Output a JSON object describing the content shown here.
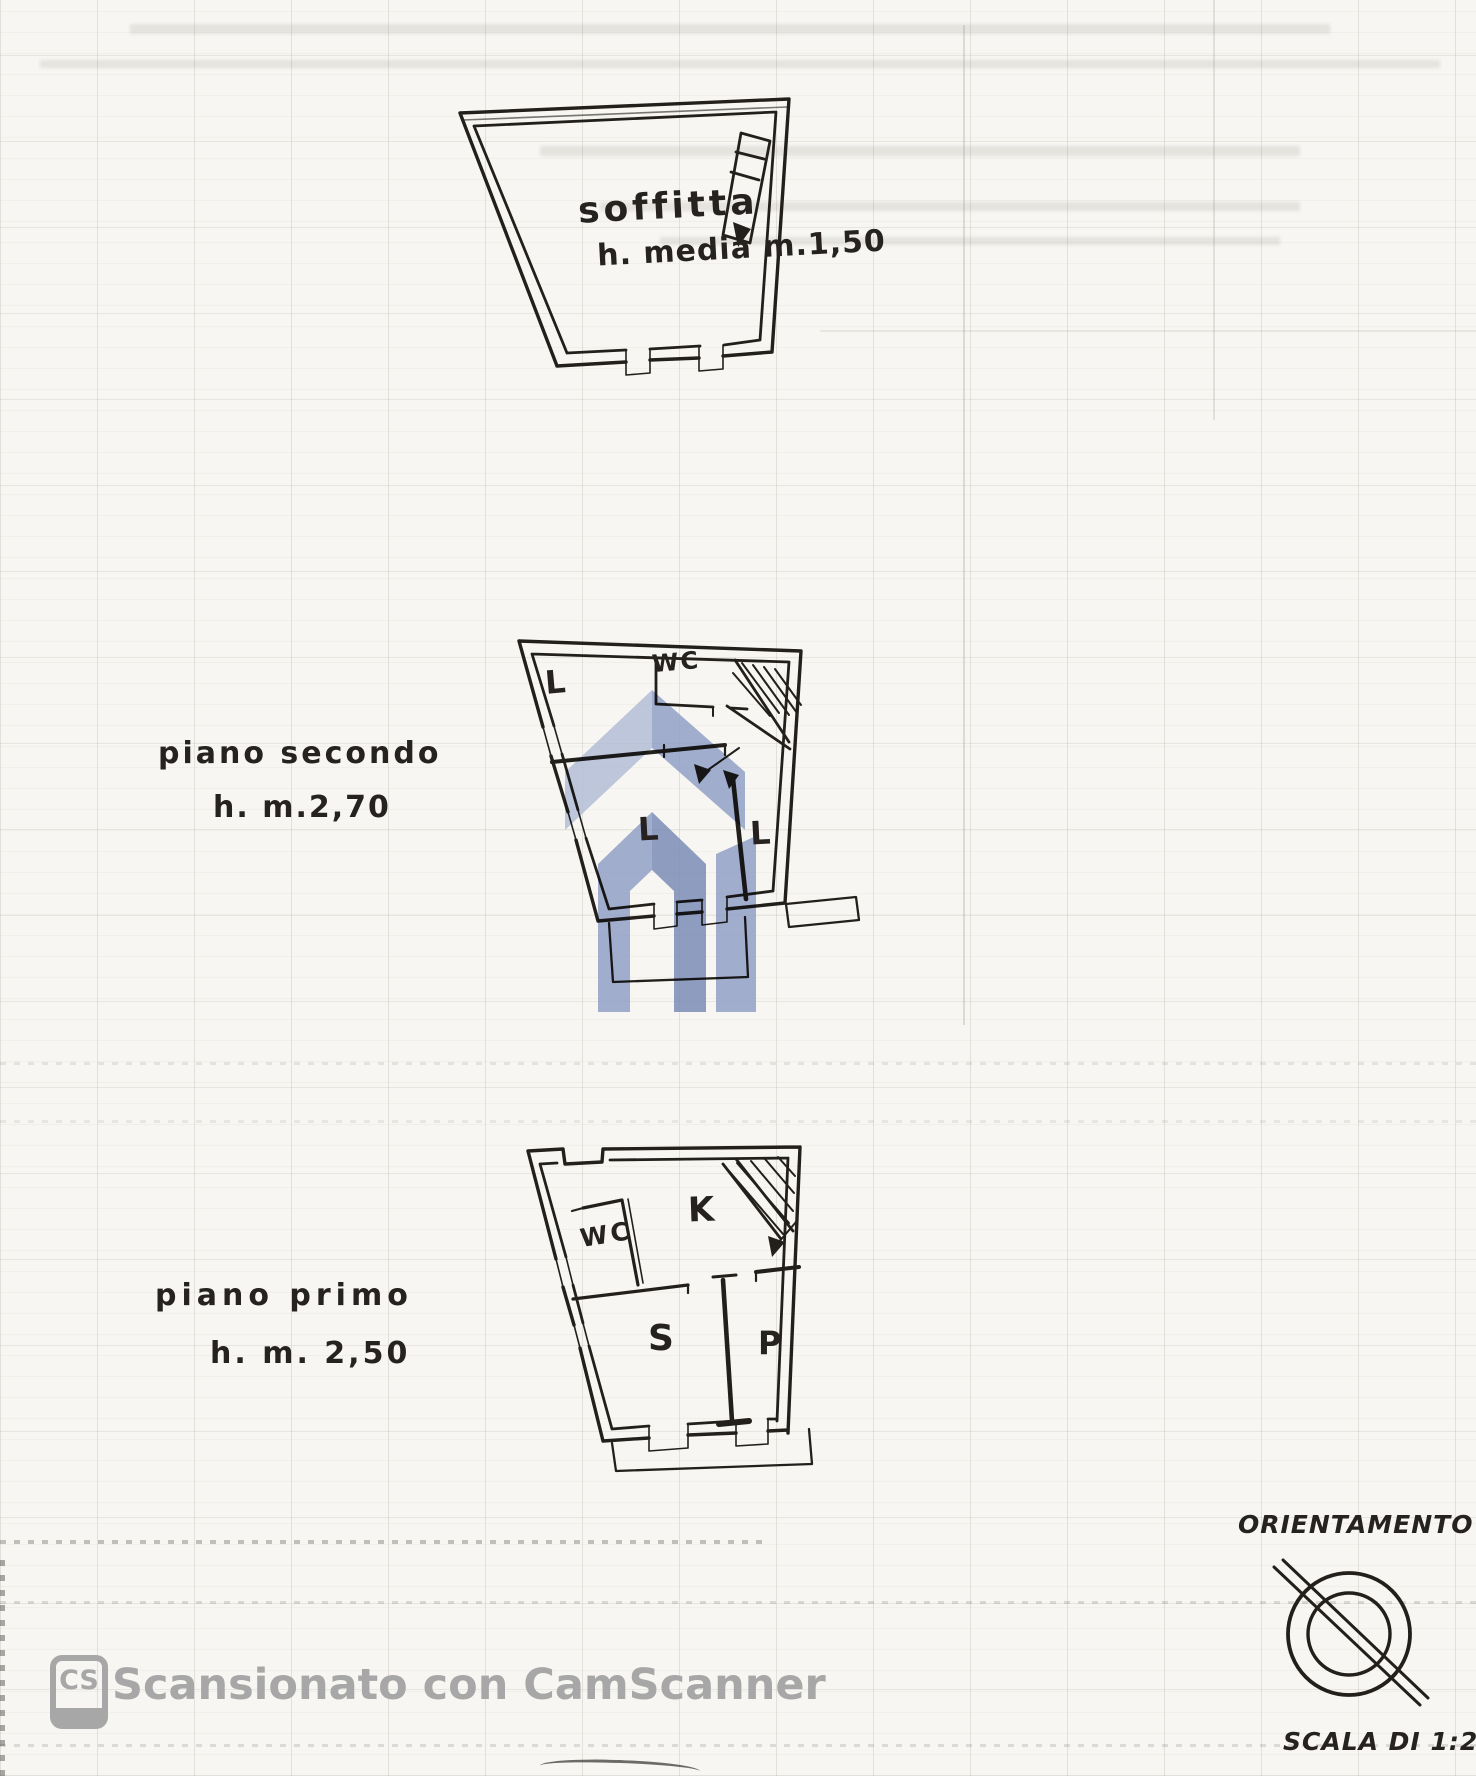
{
  "colors": {
    "ink": "#23201c",
    "paper": "#f7f6f2",
    "watermark_gray": "#a7a7a7",
    "logo_light": "#b0bbd4",
    "logo_mid": "#8d9cc4",
    "logo_dark": "#7687b5"
  },
  "soffitta": {
    "room_label": "soffitta",
    "height_label": "h. media m.1,50"
  },
  "piano_secondo": {
    "floor_label": "piano secondo",
    "height_label": "h. m.2,70",
    "room_l_top": "L",
    "room_wc": "WC",
    "room_l_left": "L",
    "room_l_right": "L"
  },
  "piano_primo": {
    "floor_label": "piano primo",
    "height_label": "h. m. 2,50",
    "room_wc": "WC",
    "room_k": "K",
    "room_s": "S",
    "room_p": "P"
  },
  "orientation_label": "ORIENTAMENTO",
  "scale_label": "SCALA DI 1:200",
  "scanner": {
    "badge": "CS",
    "text": "Scansionato con CamScanner"
  }
}
